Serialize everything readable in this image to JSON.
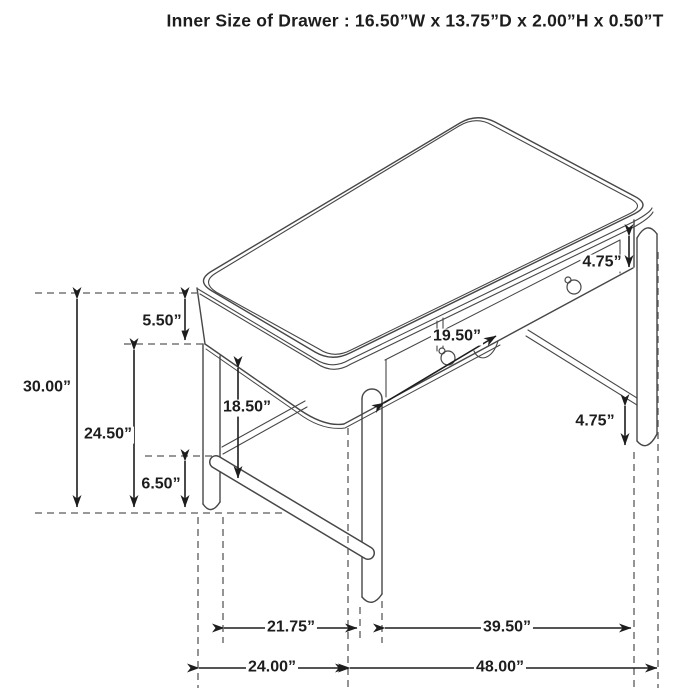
{
  "title": "Inner Size of Drawer : 16.50”W x 13.75”D x 2.00”H x 0.50”T",
  "diagram": {
    "type": "furniture-dimension-diagram",
    "subject": "two-drawer writing desk, isometric line drawing with dimension arrows",
    "dimensions": {
      "top_and_apron_height": "5.50”",
      "overall_height": "30.00”",
      "underside_clearance_height": "24.50”",
      "stretcher_height_left": "6.50”",
      "apron_to_stretcher": "18.50”",
      "drawer_front_width": "19.50”",
      "right_apron_height": "4.75”",
      "right_stretcher_height": "4.75”",
      "leg_span_depth": "21.75”",
      "leg_span_length": "39.50”",
      "top_depth": "24.00”",
      "top_length": "48.00”"
    },
    "colors": {
      "line": "#474747",
      "dashed_line": "#5a5a5a",
      "arrow": "#1d1d1d",
      "text": "#1d1d1d",
      "background": "#ffffff"
    }
  }
}
